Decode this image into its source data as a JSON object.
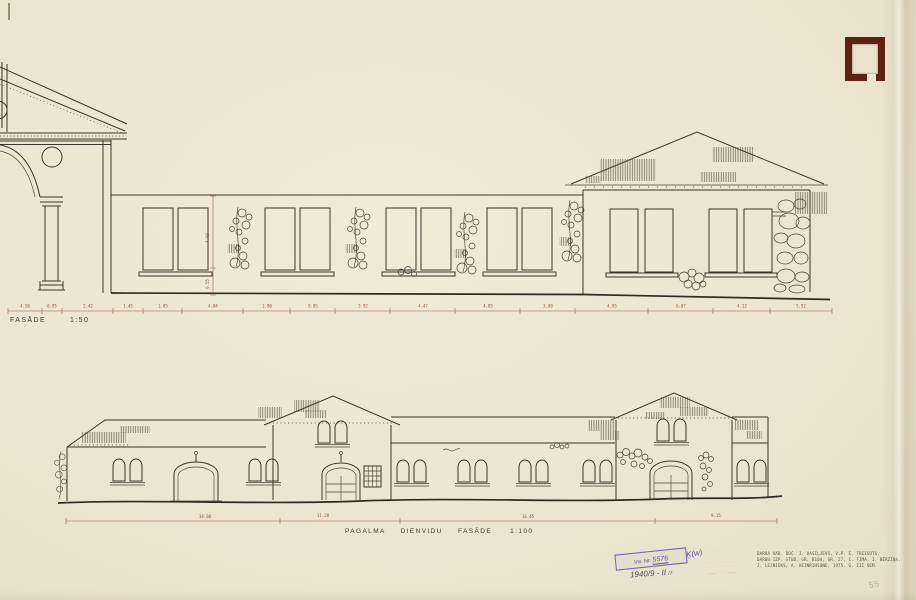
{
  "elevations": {
    "top": {
      "label": "FASĀDE",
      "scale": "1:50"
    },
    "bottom": {
      "label": "PAGALMA DIENVIDU FASĀDE",
      "scale": "1:100"
    }
  },
  "dimensions": {
    "top_line": [
      "4.50",
      "0.95",
      "2.42",
      "1.45",
      "1.85",
      "4.04",
      "1.90",
      "0.95",
      "3.92",
      "4.47",
      "4.85",
      "3.80",
      "4.95",
      "6.07",
      "4.12",
      "5.52"
    ],
    "top_vertical": [
      "4.08",
      "0.55"
    ],
    "bottom_line": [
      "34.80",
      "11.28",
      "16.45",
      "9.15"
    ]
  },
  "stamps": {
    "inventory": {
      "line1": "· · · · · · ·  · · · ·",
      "inv_label": "Inv. Nr.",
      "inv_number": "5576",
      "side_note": "Ķ(w)",
      "handwritten": "1940/9 - II",
      "handwritten_small": "/7"
    },
    "red_stamp": {
      "lines": [
        "· · · · · ·",
        "· · · · · · · · ·",
        "· · · · ·  · · · · ·",
        "· · · ·  · · · · ·",
        "—— · ~ · ——"
      ]
    },
    "credits": {
      "lines": [
        "DARBA VAD. DOC. J. VASIĻJEVS, V.P. E. TREIGŪTS,",
        "DARBU IZP. STUD. GR. B104, GR. 27, I. TIMA, I. BĒRZIŅA,",
        "J. LEJNIEKS, A. HEINRIHSONE, 1975. G. III SEM."
      ]
    },
    "pencil_note": "55"
  },
  "colors": {
    "paper": "#ece4d0",
    "ink": "#3c362c",
    "dimension": "#9a5a42",
    "stamp_purple": "#6b4fa0",
    "stamp_red": "#cf7a66",
    "corner_mark": "#5e2214",
    "pencil": "#b3a98f"
  }
}
